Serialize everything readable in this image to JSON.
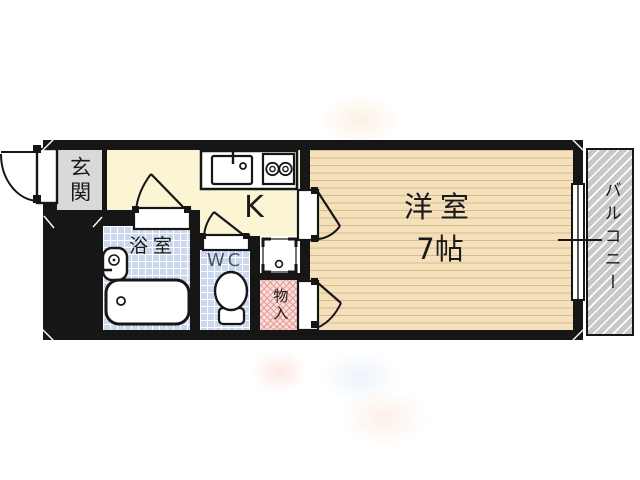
{
  "floor_plan": {
    "rooms": {
      "genkan": {
        "label": "玄関"
      },
      "kitchen": {
        "label": "K"
      },
      "bath": {
        "label": "浴室"
      },
      "wc": {
        "label": "WC"
      },
      "storage": {
        "label": "物入"
      },
      "main_room": {
        "label": "洋室",
        "size": "7帖"
      },
      "balcony": {
        "label": "バルコニー"
      }
    },
    "fixtures": [
      "entrance-door",
      "bath-door",
      "wc-door",
      "room-door",
      "closet-door",
      "kitchen-sink",
      "gas-stove",
      "washbasin",
      "bathtub",
      "toilet",
      "washing-machine-pad",
      "sliding-window"
    ],
    "colors": {
      "wall": "#161616",
      "genkan_floor": "#d9d9d9",
      "kitchen_floor": "#fbf5d4",
      "tile_floor": "#ccd8ee",
      "room_floor": "#f4e0ba",
      "room_floor_line": "#d8ba8e",
      "storage_floor": "#f8ddda",
      "storage_hatch": "#e49b94",
      "balcony_floor": "#c8c8c8",
      "wc_text": "#4a5264"
    }
  }
}
